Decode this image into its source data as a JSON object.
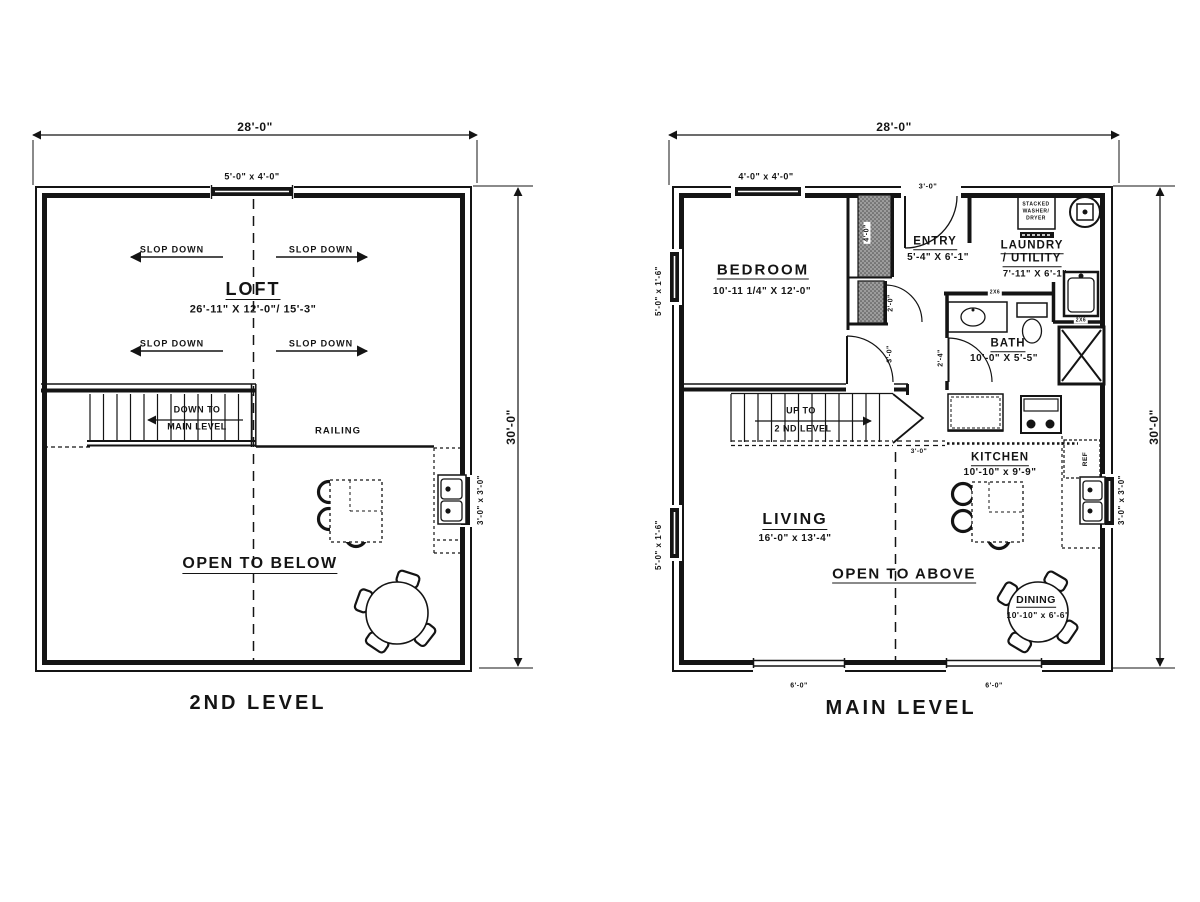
{
  "page": {
    "background": "#ffffff",
    "line_color": "#141414"
  },
  "second_level": {
    "title": "2ND LEVEL",
    "dim_top": "28'-0\"",
    "dim_right": "30'-0\"",
    "window_top": "5'-0\" x 4'-0\"",
    "window_right": "3'-0\" x 3'-0\"",
    "room": "LOFT",
    "room_dims": "26'-11\" X 12'-0\"/ 15'-3\"",
    "slope_label": "SLOP DOWN",
    "stair_line1": "DOWN TO",
    "stair_line2": "MAIN LEVEL",
    "railing": "RAILING",
    "open_label": "OPEN TO BELOW"
  },
  "main_level": {
    "title": "MAIN LEVEL",
    "dim_top": "28'-0\"",
    "dim_right": "30'-0\"",
    "window_top": "4'-0\" x 4'-0\"",
    "window_left": "5'-0\" x 1'-6\"",
    "window_right": "3'-0\" x 3'-0\"",
    "window_bottom": "6'-0\"",
    "wall_labels": [
      "2X6",
      "2X6"
    ],
    "bedroom": {
      "name": "BEDROOM",
      "dims": "10'-11 1/4\" X 12'-0\"",
      "door": "3'-0\"",
      "closet_depth": "4'-0\"",
      "closet_door": "2'-0\""
    },
    "entry": {
      "name": "ENTRY",
      "dims": "5'-4\" X 6'-1\"",
      "door": "3'-0\""
    },
    "laundry": {
      "name": "LAUNDRY",
      "name2": "/ UTILITY",
      "dims": "7'-11\" X 6'-1\"",
      "washer": [
        "STACKED",
        "WASHER/",
        "DRYER"
      ]
    },
    "bath": {
      "name": "BATH",
      "dims": "10'-0\" X 5'-5\"",
      "door": "2'-4\""
    },
    "stairs": {
      "line1": "UP TO",
      "line2": "2 ND LEVEL",
      "clearance": "3'-0\""
    },
    "kitchen": {
      "name": "KITCHEN",
      "dims": "10'-10\" x 9'-9\"",
      "ref": "REF"
    },
    "living": {
      "name": "LIVING",
      "dims": "16'-0\" x 13'-4\""
    },
    "open_label": "OPEN TO ABOVE",
    "dining": {
      "name": "DINING",
      "dims": "10'-10\" x 6'-6\""
    }
  }
}
